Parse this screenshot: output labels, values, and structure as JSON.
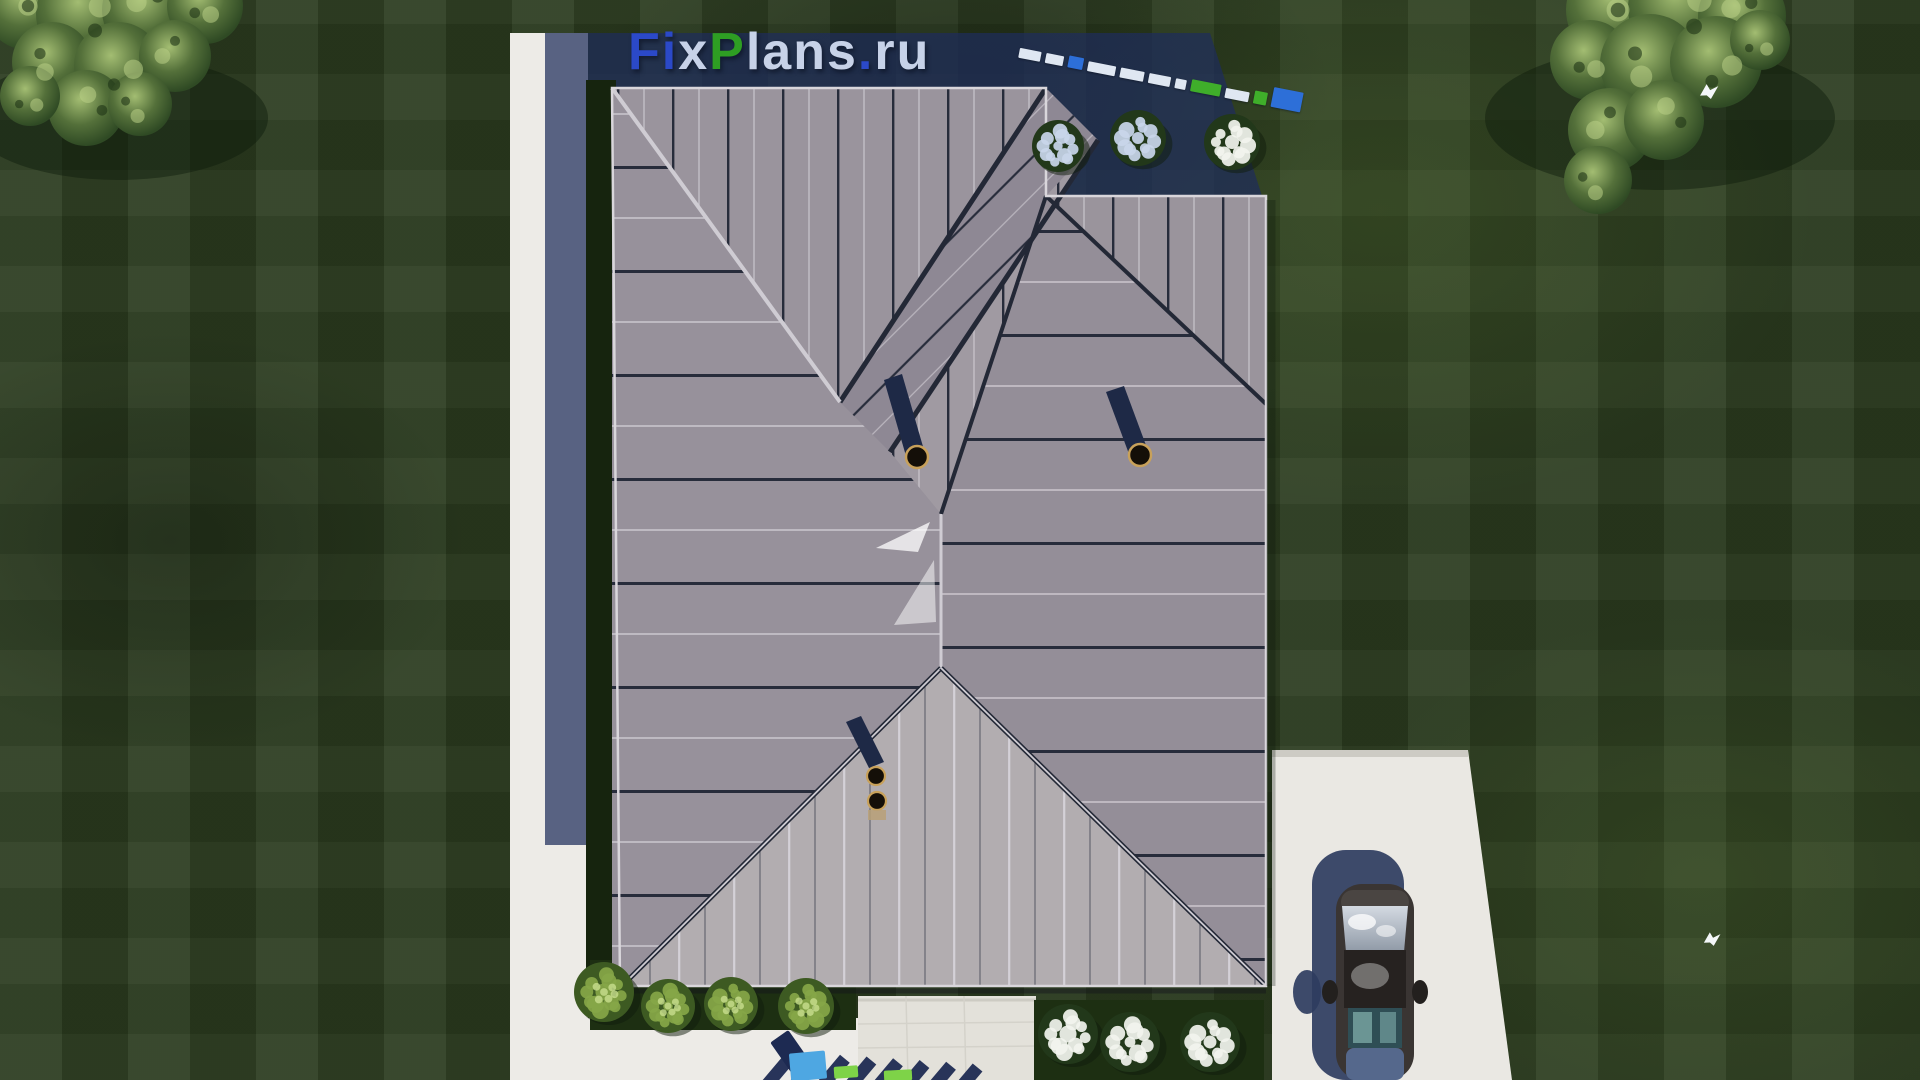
{
  "scene_description": "aerial 3d render of house roof plan on green lawn",
  "watermark": {
    "text": "FixPlans.ru",
    "letters": [
      {
        "ch": "F",
        "tone": "blue"
      },
      {
        "ch": "i",
        "tone": "blue"
      },
      {
        "ch": "x",
        "tone": "light"
      },
      {
        "ch": "P",
        "tone": "green"
      },
      {
        "ch": "l",
        "tone": "light"
      },
      {
        "ch": "a",
        "tone": "light"
      },
      {
        "ch": "n",
        "tone": "light"
      },
      {
        "ch": "s",
        "tone": "light"
      },
      {
        "ch": ".",
        "tone": "blue"
      },
      {
        "ch": "r",
        "tone": "light"
      },
      {
        "ch": "u",
        "tone": "light"
      }
    ]
  },
  "mini_watermark_blocks": [
    {
      "c": "light",
      "w": 22,
      "h": 10
    },
    {
      "c": "light",
      "w": 18,
      "h": 10
    },
    {
      "c": "blue",
      "w": 15,
      "h": 12
    },
    {
      "c": "light",
      "w": 28,
      "h": 10
    },
    {
      "c": "light",
      "w": 24,
      "h": 10
    },
    {
      "c": "light",
      "w": 22,
      "h": 10
    },
    {
      "c": "light",
      "w": 11,
      "h": 10
    },
    {
      "c": "green",
      "w": 30,
      "h": 12
    },
    {
      "c": "light",
      "w": 24,
      "h": 10
    },
    {
      "c": "green",
      "w": 13,
      "h": 13
    },
    {
      "c": "blue",
      "w": 30,
      "h": 20
    }
  ],
  "bottom_watermark": {
    "blocks": [
      {
        "c": "shadow",
        "x": 782,
        "y": 1032,
        "w": 22,
        "h": 48,
        "rot": -35
      },
      {
        "c": "blue",
        "x": 790,
        "y": 1052,
        "w": 36,
        "h": 28,
        "rot": -5
      },
      {
        "c": "green",
        "x": 834,
        "y": 1066,
        "w": 24,
        "h": 12,
        "rot": -4
      },
      {
        "c": "green",
        "x": 884,
        "y": 1070,
        "w": 28,
        "h": 11,
        "rot": -3
      }
    ],
    "shadow_strokes": {
      "count": 8,
      "start_x": 826,
      "step_x": 28,
      "top_y": 1042,
      "height": 44,
      "width": 13,
      "skew": -36
    }
  },
  "palette": {
    "lawn_base": "#2c3d20",
    "shadow": "rgba(30,45,92,0.72)",
    "hedge": "#16240e",
    "path": "#edebe7",
    "pavement": "#e3e1da",
    "driveway": "#eae8e3",
    "roof_left": "#97919b",
    "roof_top_gable": "#9a949d",
    "roof_band": "#8e8894",
    "roof_mid_gable": "#a09aa2",
    "roof_right_gable": "#9a949c",
    "roof_right": "#948e98",
    "roof_tri_bottom": "#b2adb0",
    "seam_dark": "#272c3b",
    "seam_light": "#d8d5dc",
    "valley": "#232836",
    "ridge_light": "#cfccd3",
    "bed": "#1d2f12",
    "flower_white": "#f2f4ee",
    "flower_blue": "#c9d6ea",
    "shrub": "#86a648",
    "car_body": "#3a3533",
    "car_roof": "#262220",
    "windshield": "#c9d0d8",
    "rear_window": "#2f4e55",
    "trunk": "#55688c",
    "car_shadow": "#2e3c60",
    "pipe_shadow": "#1e2946",
    "pipe_ring": "#c8a15a",
    "pipe_hole": "#140f08",
    "logo_blue": "#2b49c8",
    "logo_green": "#2e9e23",
    "logo_light": "#c7d2e8",
    "wm_blue": "#4ea7e2",
    "wm_green": "#7ed348",
    "wm_shadow": "#1d2a52",
    "bird": "#f4f7f9"
  },
  "bushes": [
    {
      "x": 1058,
      "y": 146,
      "r": 26,
      "kind": "flower_blue"
    },
    {
      "x": 1138,
      "y": 138,
      "r": 28,
      "kind": "flower_blue"
    },
    {
      "x": 1232,
      "y": 142,
      "r": 28,
      "kind": "flower_white"
    },
    {
      "x": 604,
      "y": 992,
      "r": 30,
      "kind": "shrub"
    },
    {
      "x": 668,
      "y": 1006,
      "r": 27,
      "kind": "shrub"
    },
    {
      "x": 731,
      "y": 1004,
      "r": 27,
      "kind": "shrub"
    },
    {
      "x": 806,
      "y": 1006,
      "r": 28,
      "kind": "shrub"
    },
    {
      "x": 1068,
      "y": 1034,
      "r": 30,
      "kind": "flower_white"
    },
    {
      "x": 1130,
      "y": 1042,
      "r": 30,
      "kind": "flower_white"
    },
    {
      "x": 1210,
      "y": 1042,
      "r": 30,
      "kind": "flower_white"
    }
  ],
  "trees": [
    {
      "name": "tree-top-left",
      "shade": [
        118,
        118,
        150,
        62
      ],
      "lobes": [
        [
          28,
          6,
          44
        ],
        [
          86,
          14,
          50
        ],
        [
          148,
          10,
          46
        ],
        [
          205,
          6,
          38
        ],
        [
          52,
          62,
          40
        ],
        [
          118,
          66,
          44
        ],
        [
          175,
          56,
          36
        ],
        [
          86,
          108,
          38
        ],
        [
          140,
          104,
          32
        ],
        [
          30,
          96,
          30
        ]
      ]
    },
    {
      "name": "tree-top-right",
      "shade": [
        1660,
        118,
        175,
        72
      ],
      "lobes": [
        [
          1618,
          10,
          52
        ],
        [
          1684,
          8,
          56
        ],
        [
          1742,
          16,
          44
        ],
        [
          1590,
          60,
          40
        ],
        [
          1650,
          64,
          50
        ],
        [
          1716,
          62,
          46
        ],
        [
          1610,
          130,
          42
        ],
        [
          1664,
          120,
          40
        ],
        [
          1598,
          180,
          34
        ],
        [
          1760,
          40,
          30
        ]
      ]
    }
  ],
  "birds": [
    {
      "x": 1698,
      "y": 86,
      "s": 1.1
    },
    {
      "x": 1702,
      "y": 934,
      "s": 1.0
    }
  ],
  "chimney_pipes": [
    {
      "x": 917,
      "y": 457
    },
    {
      "x": 1140,
      "y": 455
    },
    {
      "x": 876,
      "y": 776
    },
    {
      "x": 877,
      "y": 801
    }
  ]
}
